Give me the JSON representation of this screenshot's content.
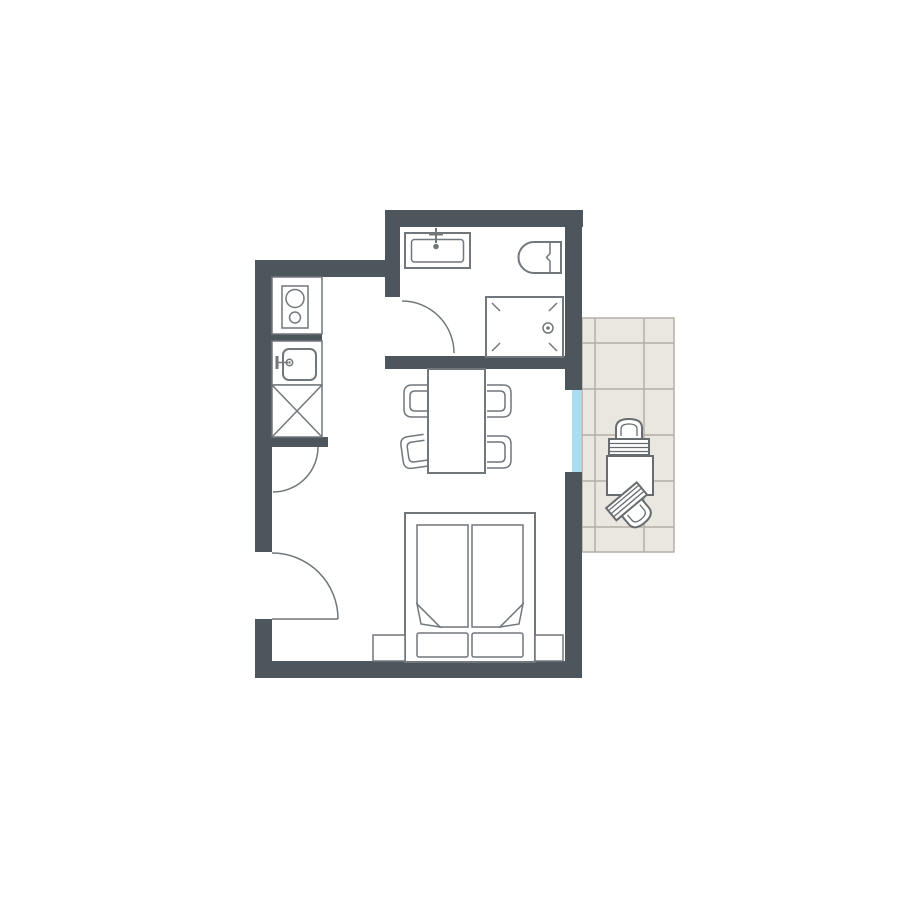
{
  "image": {
    "kind": "apartment-floor-plan",
    "visible_text": "",
    "orientation": "top-down"
  },
  "colors": {
    "background": "#ffffff",
    "wall": "#4d565c",
    "fixture_outline": "#71777b",
    "balcony_furniture_outline": "#666c70",
    "balcony_tile": "#e9e7e0",
    "balcony_tile_grid": "#b3b0a6",
    "window_glass": "#aadcf2",
    "floor": "#ffffff"
  },
  "floor_plan": {
    "rooms": [
      {
        "id": "bathroom",
        "position": "top",
        "fixtures": [
          "bathtub",
          "bathtub-faucet",
          "toilet",
          "shower-with-drain"
        ]
      },
      {
        "id": "kitchenette",
        "position": "left",
        "fixtures": [
          "two-burner-cooktop",
          "kitchen-sink",
          "storage-unit-x-symbol"
        ]
      },
      {
        "id": "main-living-sleeping-room",
        "position": "center",
        "furniture": [
          "dining-table",
          "dining-chair x4",
          "double-bed",
          "mattress x2 (folded blanket corners)",
          "pillow x2",
          "nightstand x2"
        ]
      },
      {
        "id": "balcony",
        "position": "right",
        "floor": "tiled-grid",
        "furniture": [
          "bistro-table",
          "balcony-chair x2"
        ]
      }
    ],
    "openings": [
      {
        "id": "entrance-door",
        "wall": "left-exterior",
        "symbol": "quarter-circle-swing"
      },
      {
        "id": "kitchen-door",
        "wall": "interior-kitchen-stub",
        "symbol": "quarter-circle-swing"
      },
      {
        "id": "bathroom-door",
        "wall": "interior-bathroom",
        "symbol": "quarter-circle-swing"
      },
      {
        "id": "balcony-door-window",
        "wall": "right-exterior",
        "symbol": "glazed-opening",
        "color_ref": "window_glass"
      }
    ]
  }
}
